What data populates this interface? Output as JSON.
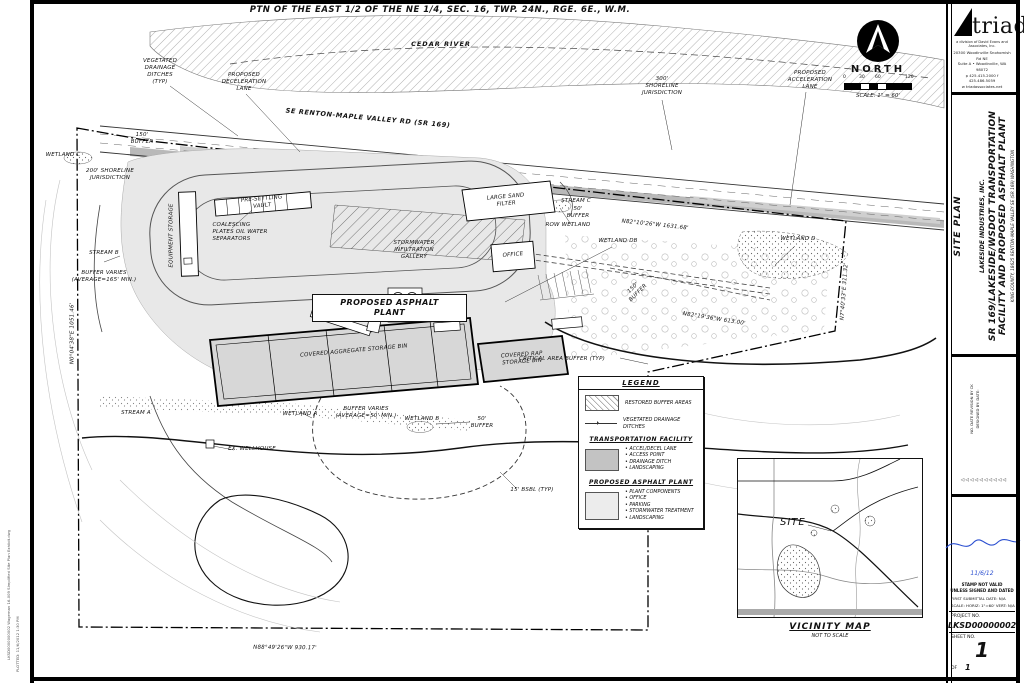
{
  "sheet": {
    "section_title": "PTN OF THE EAST 1/2 OF THE NE 1/4, SEC. 16, TWP. 24N., RGE. 6E., W.M.",
    "edge_stamp_file": "LKSD0000000002 Wageman 16-009 Simplified Site Plan Exhibit.dwg",
    "edge_stamp_plot": "PLOTTED: 11/6/2012 1:30 PM"
  },
  "compass": {
    "north": "NORTH",
    "scale": "SCALE: 1\" = 60'",
    "t0": "0",
    "t30": "30",
    "t60": "60",
    "t120": "120"
  },
  "plan": {
    "cedar_river": "CEDAR RIVER",
    "road": "SE RENTON-MAPLE VALLEY RD (SR 169)",
    "vegetated_ditches": "VEGETATED\nDRAINAGE\nDITCHES\n(TYP)",
    "decel_lane": "PROPOSED\nDECELERATION\nLANE",
    "shoreline_300": "300'\nSHORELINE\nJURISDICTION",
    "accel_lane": "PROPOSED\nACCELERATION\nLANE",
    "buffer_150": "150'\nBUFFER",
    "wetland_c": "WETLAND C",
    "shoreline_200": "200' SHORELINE\nJURISDICTION",
    "pre_settling": "PRE-SETTLING\nVAULT",
    "coalescing": "COALESCING\nPLATES OIL WATER\nSEPARATORS",
    "equipment_storage": "EQUIPMENT STORAGE",
    "sand_filter": "LARGE SAND\nFILTER",
    "stream_c": "STREAM C",
    "buffer_50_c": "50'\nBUFFER",
    "row_wetland": "ROW WETLAND",
    "bearing_top": "N82°10'26\"W  1631.68'",
    "gallery": "STORMWATER\nINFILTRATION\nGALLERY",
    "office": "OFFICE",
    "wetland_db": "WETLAND DB",
    "wetland_d": "WETLAND D",
    "buffer_150_db": "150'\nBUFFER",
    "plant_line1": "PROPOSED ASPHALT",
    "plant_line2": "PLANT",
    "stream_b": "STREAM B",
    "buffer_165": "BUFFER VARIES\n(AVERAGE=165' MIN.)",
    "agg_bin": "COVERED AGGREGATE STORAGE BIN",
    "rap_bin": "COVERED RAP\nSTORAGE BIN",
    "critical_buffer": "CRITICAL AREA BUFFER (TYP)",
    "bearing_right": "N7°40'33\"E  311.32'",
    "bearing_diag": "N82°19'36\"W  613.00'",
    "stream_a": "STREAM A",
    "wetland_a": "WETLAND A",
    "buffer_50_avg": "BUFFER VARIES\n(AVERAGE=50' MIN.)",
    "wellhouse": "EX. WELLHOUSE",
    "wetland_b": "WETLAND B",
    "buffer_50_b": "50'\nBUFFER",
    "bsbl": "15' BSBL (TYP)",
    "bearing_bottom": "N88°49'26\"W  930.17'",
    "bearing_left": "N0°04'38\"E  1051.46'",
    "bearing_mid": "N1°04'10\"E  731.99'"
  },
  "legend": {
    "title": "LEGEND",
    "restored": "RESTORED BUFFER AREAS",
    "veg_ditches": "VEGETATED DRAINAGE\nDITCHES",
    "transport_title": "TRANSPORTATION FACILITY",
    "transport_items": [
      "ACCEL/DECEL LANE",
      "ACCESS POINT",
      "DRAINAGE DITCH",
      "LANDSCAPING"
    ],
    "plant_title": "PROPOSED ASPHALT PLANT",
    "plant_items": [
      "PLANT COMPONENTS",
      "OFFICE",
      "PARKING",
      "STORMWATER TREATMENT",
      "LANDSCAPING"
    ]
  },
  "vicinity": {
    "site": "SITE",
    "title": "VICINITY MAP",
    "subtitle": "NOT TO SCALE"
  },
  "titleblock": {
    "logo": "triad",
    "tagline": "a division of David Evans and Associates, Inc.",
    "addr1": "20300 Woodinville Snohomish Rd NE",
    "addr2": "Suite A • Woodinville, WA 98072",
    "addr3": "p 425.415.2000  f 425.486.5059",
    "addr4": "w triadassociates.net",
    "sheet_title": "SITE PLAN",
    "client": "LAKESIDE INDUSTRIES, INC.",
    "project_line1": "SR 169/LAKESIDE/WSDOT TRANSPORTATION",
    "project_line2": "FACILITY AND PROPOSED ASPHALT PLANT",
    "location": "KING COUNTY,   18625 RENTON-MAPLE VALLEY SE (SR 169)   WASHINGTON",
    "rev_cols": "NO.   DATE   REVISION   BY   CK\nDESIGNED BY:        DATE:",
    "deltas": "◁◁◁◁◁◁◁◁◁◁",
    "stamp_date": "11/6/12",
    "stamp_note1": "STAMP NOT VALID",
    "stamp_note2": "UNLESS SIGNED AND DATED",
    "submittal": "FIRST SUBMITTAL DATE: N/A",
    "scale_line": "SCALE:  HORIZ: 1\"=60'   VERT: N/A",
    "project_no_label": "PROJECT NO.",
    "project_no": "LKSD00000002",
    "sheet_label": "SHEET NO.",
    "sheet_no": "1",
    "of_label": "OF",
    "of_no": "1",
    "accent_blue": "#2b4fd0"
  }
}
